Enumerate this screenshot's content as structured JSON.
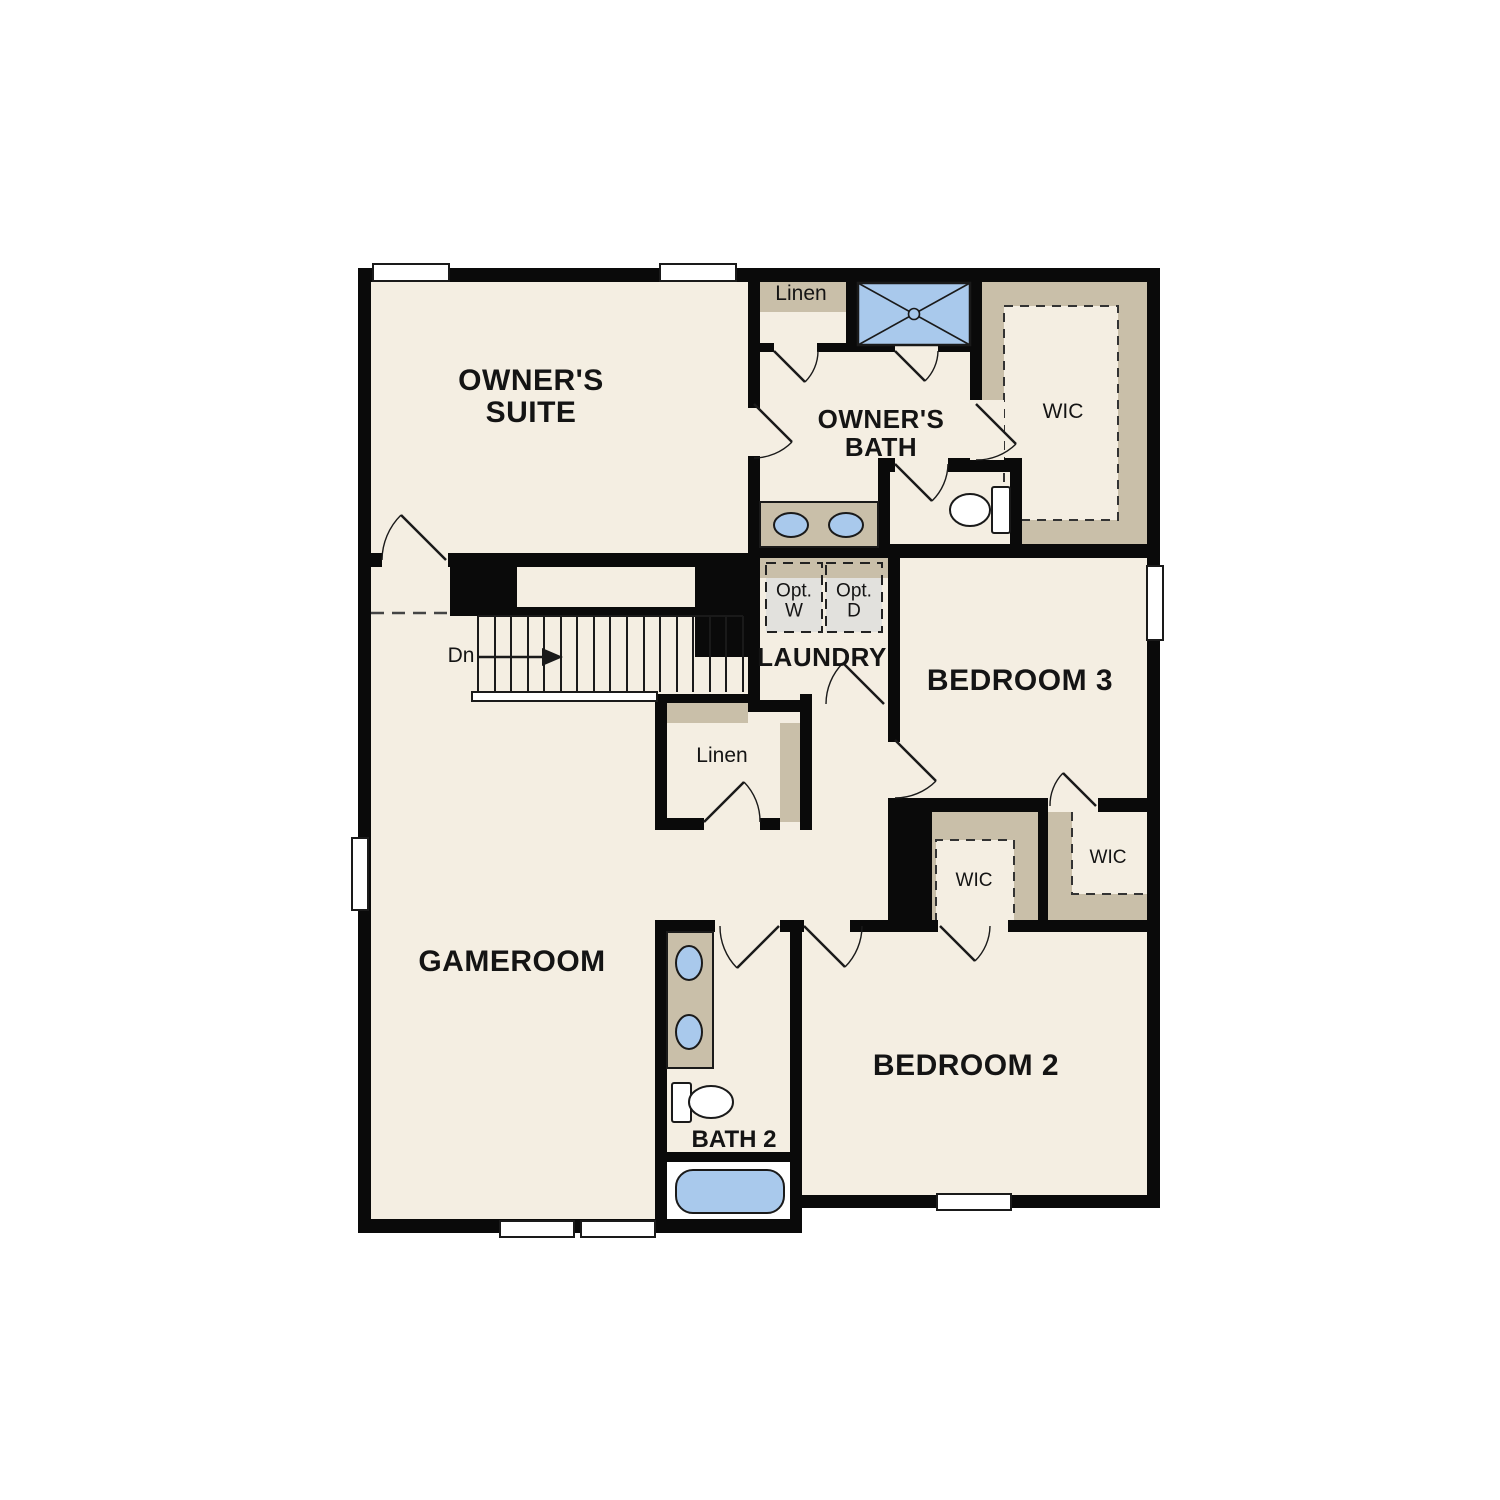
{
  "plan": {
    "title": "Second floor plan",
    "labels": {
      "owners_suite": {
        "line1": "OWNER'S",
        "line2": "SUITE"
      },
      "linen_top": "Linen",
      "owners_bath": {
        "line1": "OWNER'S",
        "line2": "BATH"
      },
      "wic_owners": "WIC",
      "opt_w": {
        "line1": "Opt.",
        "line2": "W"
      },
      "opt_d": {
        "line1": "Opt.",
        "line2": "D"
      },
      "laundry": "LAUNDRY",
      "stairs_down": "Dn",
      "bedroom3": "BEDROOM 3",
      "linen_hall": "Linen",
      "wic_bedroom2": "WIC",
      "wic_bedroom3": "WIC",
      "gameroom": "GAMEROOM",
      "bath2": "BATH 2",
      "bedroom2": "BEDROOM 2"
    },
    "colors": {
      "floor": "#f4eee2",
      "wall": "#0a0a0a",
      "casework_tan": "#c9bfa9",
      "fixture_blue": "#a9c9ec",
      "optional_gray": "#e2e1dd",
      "window_white": "#ffffff"
    }
  }
}
